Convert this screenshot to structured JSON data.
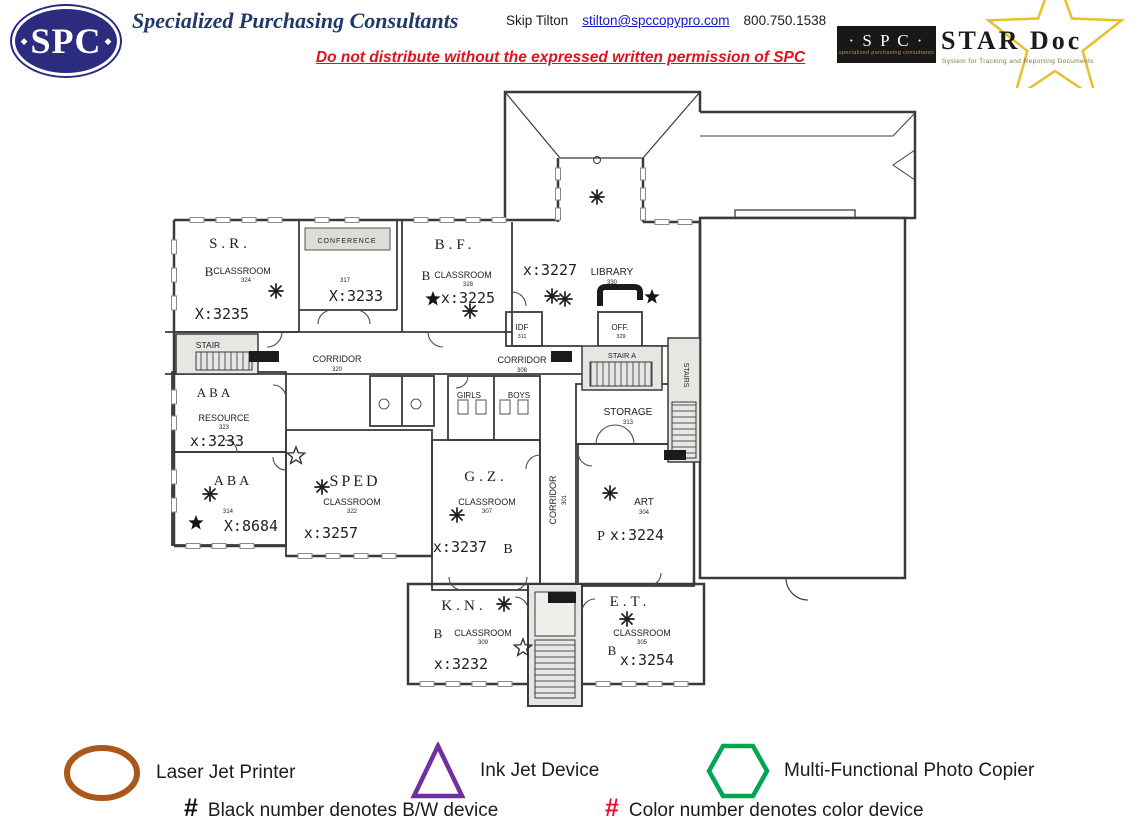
{
  "header": {
    "logo_text": "SPC",
    "company_name": "Specialized Purchasing Consultants",
    "contact": {
      "name": "Skip Tilton",
      "email": "stilton@spccopypro.com",
      "phone": "800.750.1538"
    },
    "warning": "Do not distribute without the expressed written permission of SPC",
    "stardoc": {
      "spc": "· S P C ·",
      "spc_sub": "specialized purchasing consultants",
      "title": "STAR Doc",
      "subtitle": "System for Tracking and Reporting Documents"
    }
  },
  "plan": {
    "rooms": [
      {
        "title": "S.R.",
        "device": "B",
        "type": "CLASSROOM",
        "no": "324",
        "ext": "X:3235"
      },
      {
        "title": "CONFERENCE",
        "no": "317",
        "ext": "X:3233"
      },
      {
        "title": "B.F.",
        "device": "B",
        "type": "CLASSROOM",
        "no": "328",
        "ext": "x:3225"
      },
      {
        "title": "LIBRARY",
        "no": "330",
        "ext": "x:3227"
      },
      {
        "title": "ABA",
        "type": "RESOURCE",
        "no": "323",
        "ext": "x:3233"
      },
      {
        "title": "ABA",
        "no": "314",
        "ext": "X:8684"
      },
      {
        "title": "SPED",
        "type": "CLASSROOM",
        "no": "322",
        "ext": "x:3257"
      },
      {
        "title": "G.Z.",
        "device": "B",
        "type": "CLASSROOM",
        "no": "307",
        "ext": "x:3237"
      },
      {
        "title": "STORAGE",
        "no": "313"
      },
      {
        "title": "ART",
        "device": "P",
        "no": "304",
        "ext": "x:3224"
      },
      {
        "title": "OFF.",
        "no": "329"
      },
      {
        "title": "IDF",
        "no": "311"
      },
      {
        "title": "GIRLS"
      },
      {
        "title": "BOYS"
      },
      {
        "title": "K.N.",
        "device": "B",
        "type": "CLASSROOM",
        "no": "309",
        "ext": "x:3232"
      },
      {
        "title": "E.T.",
        "device": "B",
        "type": "CLASSROOM",
        "no": "305",
        "ext": "x:3254"
      }
    ],
    "corridors": [
      {
        "label": "CORRIDOR",
        "no": "320"
      },
      {
        "label": "CORRIDOR",
        "no": "308"
      },
      {
        "label": "CORRIDOR",
        "no": "301"
      }
    ],
    "stairs": [
      {
        "label": "STAIR"
      },
      {
        "label": "STAIR A"
      },
      {
        "label": "STAIRS"
      }
    ]
  },
  "legend": {
    "items": [
      {
        "shape": "ellipse",
        "color": "#a9571a",
        "label": "Laser Jet Printer"
      },
      {
        "shape": "triangle",
        "color": "#7030a0",
        "label": "Ink Jet Device"
      },
      {
        "shape": "hexagon",
        "color": "#00a651",
        "label": "Multi-Functional Photo Copier"
      }
    ],
    "notes": [
      {
        "symbol": "#",
        "color": "#111111",
        "text": "Black number denotes B/W device"
      },
      {
        "symbol": "#",
        "color": "#e8112d",
        "text": "Color number denotes color device"
      }
    ]
  },
  "colors": {
    "brand_navy": "#2b2b80",
    "title_navy": "#1d3a6b",
    "warning_red": "#e0121d",
    "link_blue": "#1515c8",
    "star_gold": "#e4c228"
  }
}
